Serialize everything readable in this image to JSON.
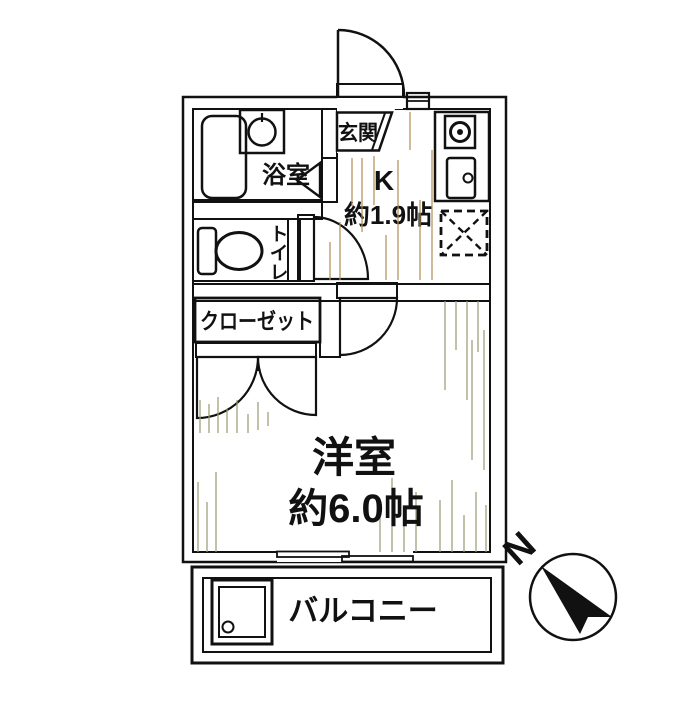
{
  "plan": {
    "entrance_label": "玄関",
    "kitchen_label": "K",
    "kitchen_size": "約1.9帖",
    "bathroom_label": "浴室",
    "toilet_label": "トイレ",
    "closet_label": "クローゼット",
    "room_label": "洋室",
    "room_size": "約6.0帖",
    "balcony_label": "バルコニー",
    "compass_north": "N"
  },
  "colors": {
    "wall": "#9b9b9b",
    "bathroom": "#dde6e9",
    "kitchen": "#f3e3c3",
    "western_room": "#f7f7dd",
    "closet": "#d5bf8e",
    "counter": "#f7ecd2",
    "outline": "#111111"
  }
}
